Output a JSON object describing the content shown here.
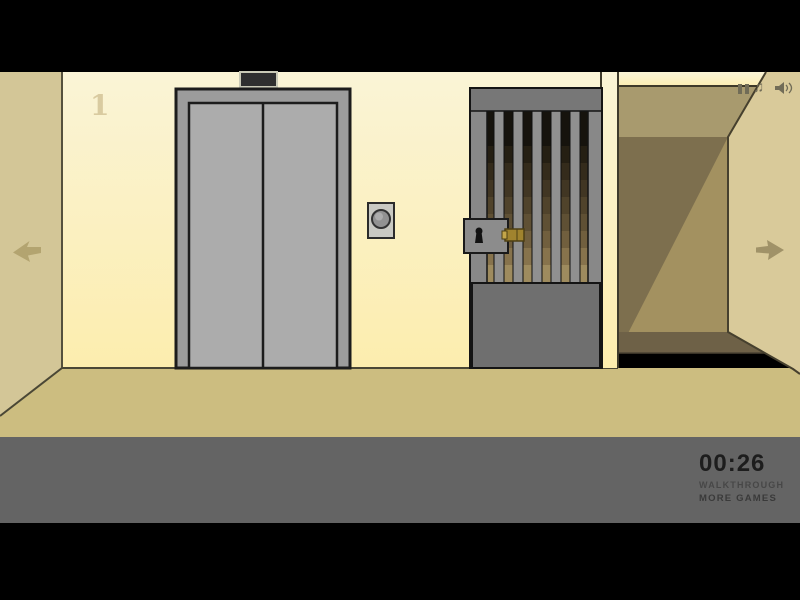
{
  "hud": {
    "floor_label": "1",
    "timer": "00:26",
    "walkthrough_label": "WALKTHROUGH",
    "more_games_label": "MORE GAMES",
    "music_note_glyph": "♫"
  },
  "icons": {
    "top_right": [
      "pause-icon",
      "music-note-icon",
      "speaker-icon"
    ],
    "navigation": [
      "left-arrow-icon",
      "right-arrow-icon"
    ]
  },
  "colors": {
    "wall_cream_top": "#faf4d6",
    "wall_cream_bottom": "#fcedae",
    "side_wall_tan": "#d3c697",
    "floor_tan": "#ccbd80",
    "corridor_ceiling": "#a89a6e",
    "corridor_back_wall": "#a39160",
    "corridor_shadow": "#7d6f4e",
    "corridor_floor": "#6e6147",
    "right_wall": "#d9ca9a",
    "elevator_frame_gray": "#9c9c9c",
    "elevator_door_gray": "#acacac",
    "gate_gray": "#7a7a7a",
    "brass_latch": "#a0832e",
    "hud_bar_gray": "#646464",
    "timer_text": "#1d1d1d"
  }
}
